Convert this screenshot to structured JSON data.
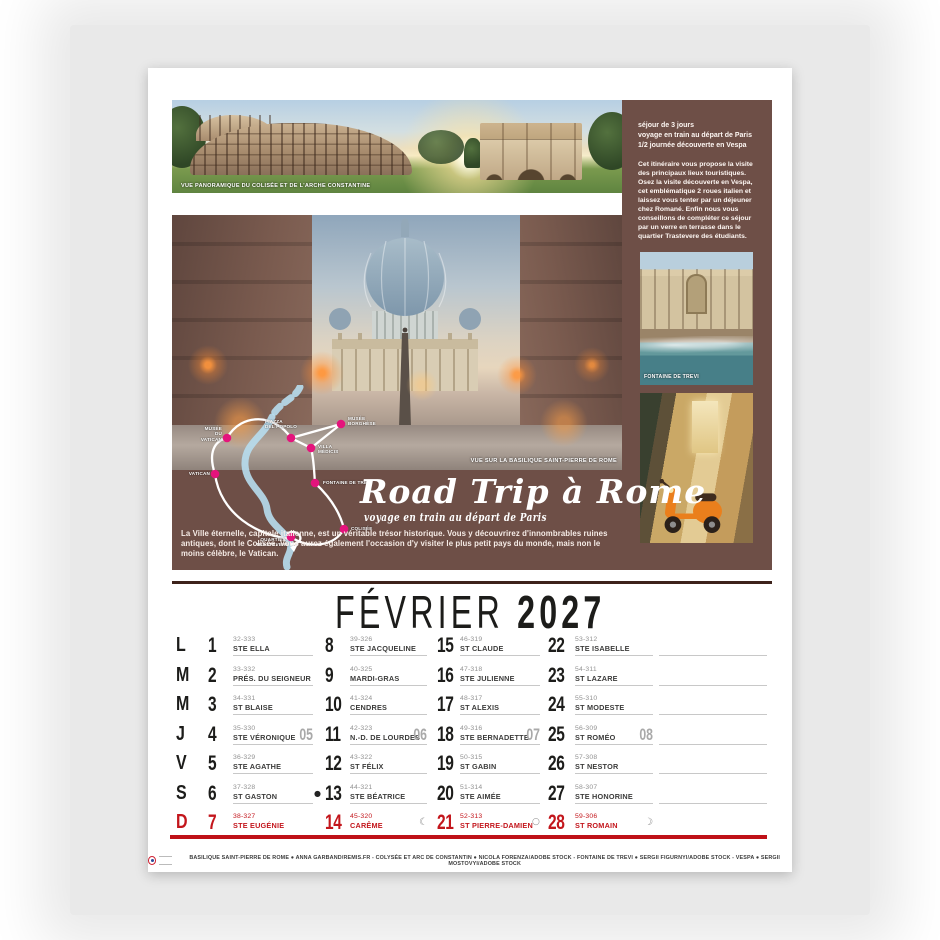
{
  "colors": {
    "hero_brown": "#6e4f47",
    "sunday_red": "#c3161c",
    "map_dot_magenta": "#e4147c",
    "river_blue": "#b7ddee",
    "page_background": "#e9e9e9"
  },
  "month_header": {
    "month": "FÉVRIER",
    "year": "2027"
  },
  "hero": {
    "panorama_caption": "VUE PANORAMIQUE DU COLISÉE ET DE L'ARCHE CONSTANTINE",
    "basilica_caption": "VUE SUR LA BASILIQUE SAINT-PIERRE DE ROME",
    "trevi_caption": "FONTAINE DE TREVI",
    "info_block": {
      "lines": [
        "séjour de 3 jours",
        "voyage en train au départ de Paris",
        "1/2 journée découverte en Vespa"
      ],
      "paragraph": "Cet itinéraire vous propose la visite des principaux lieux touristiques. Osez la visite découverte en Vespa, cet emblématique 2 roues italien et laissez vous tenter par un déjeuner chez Romané. Enfin nous vous conseillons de compléter ce séjour par un verre en terrasse dans le quartier Trastevere des étudiants.",
      "text_color": "#ffffff"
    },
    "title": "Road Trip à Rome",
    "subtitle": "voyage en train au départ de Paris",
    "description": "La Ville éternelle, capitale italienne, est un véritable trésor historique. Vous y découvrirez d'innombrables ruines antiques, dont le Colisée. Vous aurez également l'occasion d'y visiter le plus petit pays du monde, mais non le moins célèbre, le Vatican.",
    "map": {
      "labels": [
        "MUSÉE\nDU VATICAN",
        "PIAZZA\nDEL POPOLO",
        "MUSÉE\nBORGHÈSE",
        "VILLA\nMÉDICIS",
        "VATICAN",
        "FONTAINE DE TRÉVI",
        "COLISÉE",
        "QUARTIER\nTRASTEVERE"
      ]
    }
  },
  "calendar": {
    "rows": [
      {
        "day": "L",
        "cells": [
          {
            "num": "1",
            "code": "32-333",
            "name": "STE ELLA"
          },
          {
            "num": "8",
            "code": "39-326",
            "name": "STE JACQUELINE"
          },
          {
            "num": "15",
            "code": "46-319",
            "name": "ST CLAUDE"
          },
          {
            "num": "22",
            "code": "53-312",
            "name": "STE ISABELLE"
          }
        ]
      },
      {
        "day": "M",
        "cells": [
          {
            "num": "2",
            "code": "33-332",
            "name": "PRÉS. DU SEIGNEUR"
          },
          {
            "num": "9",
            "code": "40-325",
            "name": "MARDI-GRAS"
          },
          {
            "num": "16",
            "code": "47-318",
            "name": "STE JULIENNE"
          },
          {
            "num": "23",
            "code": "54-311",
            "name": "ST LAZARE"
          }
        ]
      },
      {
        "day": "M",
        "cells": [
          {
            "num": "3",
            "code": "34-331",
            "name": "ST BLAISE"
          },
          {
            "num": "10",
            "code": "41-324",
            "name": "CENDRES"
          },
          {
            "num": "17",
            "code": "48-317",
            "name": "ST ALEXIS"
          },
          {
            "num": "24",
            "code": "55-310",
            "name": "ST MODESTE"
          }
        ]
      },
      {
        "day": "J",
        "cells": [
          {
            "num": "4",
            "code": "35-330",
            "name": "STE VÉRONIQUE",
            "week": "05"
          },
          {
            "num": "11",
            "code": "42-323",
            "name": "N.-D. DE LOURDES",
            "week": "06"
          },
          {
            "num": "18",
            "code": "49-316",
            "name": "STE BERNADETTE",
            "week": "07"
          },
          {
            "num": "25",
            "code": "56-309",
            "name": "ST ROMÉO",
            "week": "08"
          }
        ]
      },
      {
        "day": "V",
        "cells": [
          {
            "num": "5",
            "code": "36-329",
            "name": "STE AGATHE"
          },
          {
            "num": "12",
            "code": "43-322",
            "name": "ST FÉLIX"
          },
          {
            "num": "19",
            "code": "50-315",
            "name": "ST GABIN"
          },
          {
            "num": "26",
            "code": "57-308",
            "name": "ST NESTOR"
          }
        ]
      },
      {
        "day": "S",
        "cells": [
          {
            "num": "6",
            "code": "37-328",
            "name": "ST GASTON",
            "moon": "●"
          },
          {
            "num": "13",
            "code": "44-321",
            "name": "STE BÉATRICE"
          },
          {
            "num": "20",
            "code": "51-314",
            "name": "STE AIMÉE"
          },
          {
            "num": "27",
            "code": "58-307",
            "name": "STE HONORINE"
          }
        ]
      },
      {
        "day": "D",
        "cells": [
          {
            "num": "7",
            "code": "38-327",
            "name": "STE EUGÉNIE"
          },
          {
            "num": "14",
            "code": "45-320",
            "name": "CARÊME",
            "moon": "☾"
          },
          {
            "num": "21",
            "code": "52-313",
            "name": "ST PIERRE-DAMIEN",
            "moon": "○"
          },
          {
            "num": "28",
            "code": "59-306",
            "name": "ST ROMAIN",
            "moon": "☽"
          }
        ]
      }
    ]
  },
  "credits": {
    "text": "BASILIQUE SAINT-PIERRE DE ROME ● ANNA GARBAND/REMIS.FR - COLYSÉE ET ARC DE CONSTANTIN ● NICOLA FORENZA/ADOBE STOCK - FONTAINE DE TREVI ● SERGII FIGURNYI/ADOBE STOCK - VESPA ● SERGII MOSTOVYI/ADOBE STOCK"
  }
}
